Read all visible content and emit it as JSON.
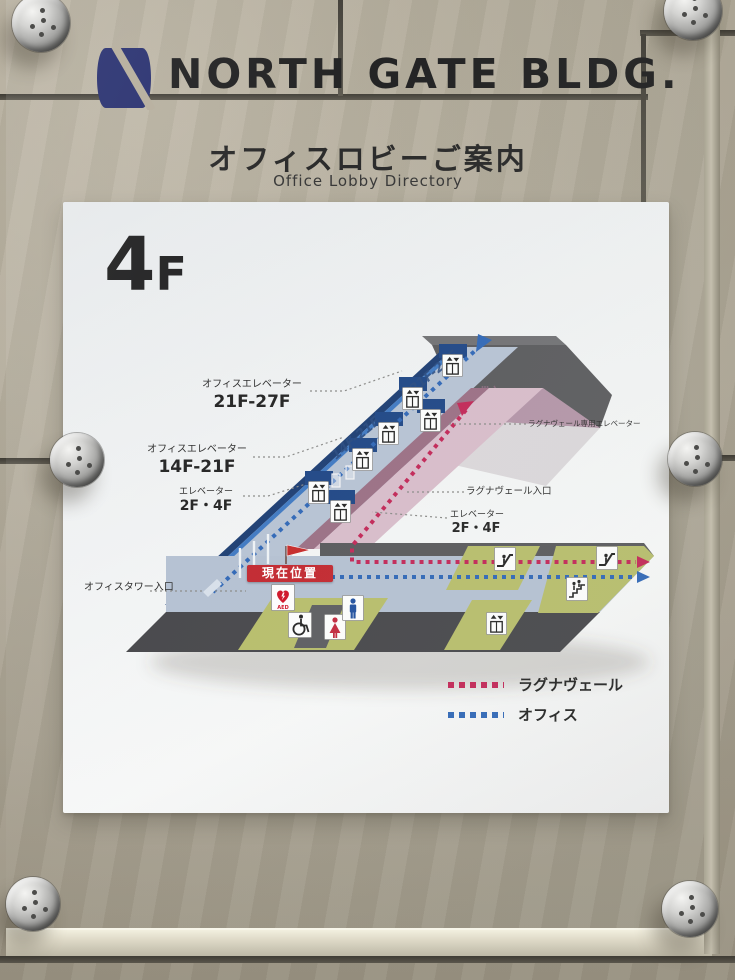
{
  "sign": {
    "building": "NORTH GATE BLDG.",
    "title_ja": "オフィスロビーご案内",
    "title_en": "Office Lobby Directory",
    "floor_big": "4",
    "floor_small": "F"
  },
  "map": {
    "floor_texts": {
      "upper": "21F-27F",
      "lower": "14F-21F"
    },
    "labels": {
      "office_elev_high": {
        "line1": "オフィスエレベーター",
        "line2": "21F-27F"
      },
      "office_elev_mid": {
        "line1": "オフィスエレベーター",
        "line2": "14F-21F"
      },
      "elev_low_left": {
        "line1": "エレベーター",
        "line2": "2F・4F"
      },
      "office_tower_entrance": "オフィスタワー入口",
      "lagna_elev": "ラグナヴェール専用エレベーター",
      "lagna_entrance": "ラグナヴェール入口",
      "elev_low_right": {
        "line1": "エレベーター",
        "line2": "2F・4F"
      },
      "current_location": "現在位置",
      "aed": "AED"
    },
    "legend": {
      "items": [
        {
          "label": "ラグナヴェール",
          "color": "#c22556"
        },
        {
          "label": "オフィス",
          "color": "#2e66b6"
        }
      ]
    }
  },
  "colors": {
    "logo_navy": "#262e6e",
    "office_route_blue": "#2e66b6",
    "lagna_route_red": "#c22556",
    "corridor_floor": "#b6c2d4",
    "wall_blue": "#3e78c2",
    "lagna_pink": "#d8bcca",
    "service_green": "#b7bd6a",
    "roof_gray": "#59595c",
    "wall_beige": "#b5ad9b"
  }
}
